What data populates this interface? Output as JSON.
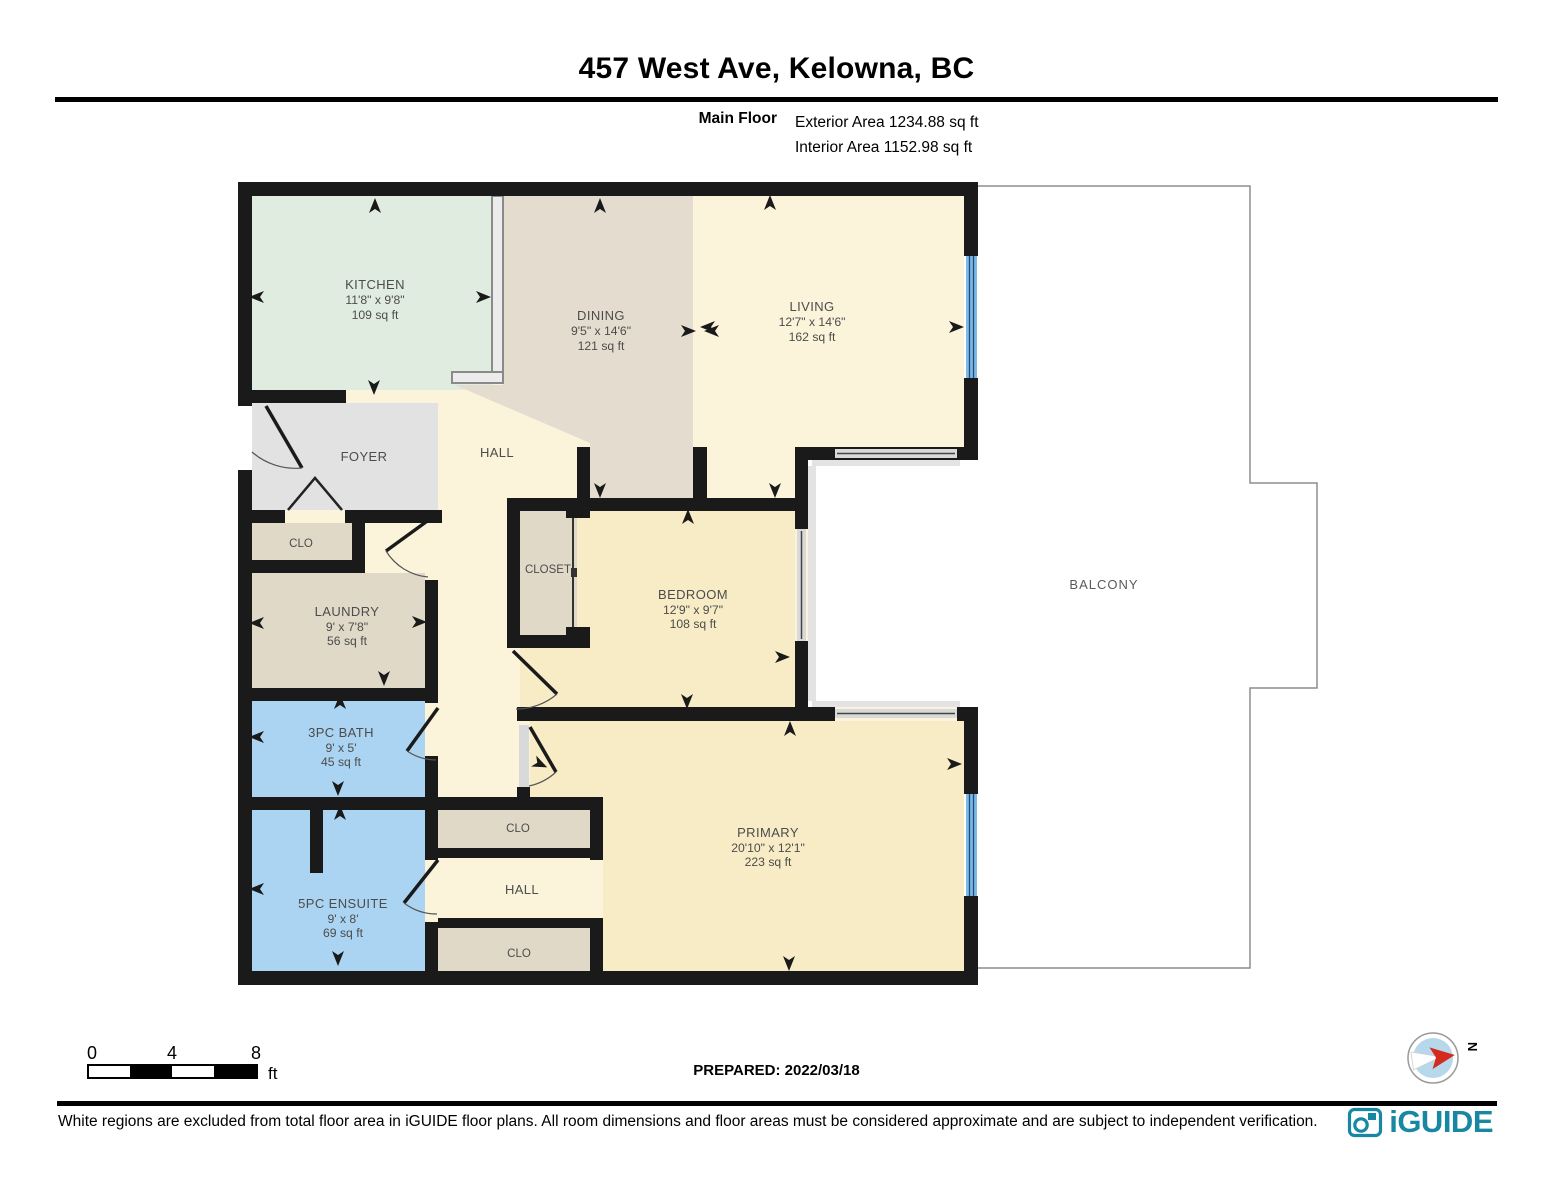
{
  "header": {
    "title": "457 West Ave, Kelowna, BC",
    "floor_label": "Main Floor",
    "exterior_area": "Exterior Area 1234.88 sq ft",
    "interior_area": "Interior Area 1152.98 sq ft"
  },
  "rooms": {
    "kitchen": {
      "name": "KITCHEN",
      "dims": "11'8\" x 9'8\"",
      "area": "109 sq ft"
    },
    "dining": {
      "name": "DINING",
      "dims": "9'5\" x 14'6\"",
      "area": "121 sq ft"
    },
    "living": {
      "name": "LIVING",
      "dims": "12'7\" x 14'6\"",
      "area": "162 sq ft"
    },
    "foyer": {
      "name": "FOYER"
    },
    "hall_upper": {
      "name": "HALL"
    },
    "clo_foyer": {
      "name": "CLO"
    },
    "laundry": {
      "name": "LAUNDRY",
      "dims": "9' x 7'8\"",
      "area": "56 sq ft"
    },
    "closet_bedroom": {
      "name": "CLOSET"
    },
    "bedroom": {
      "name": "BEDROOM",
      "dims": "12'9\" x 9'7\"",
      "area": "108 sq ft"
    },
    "balcony": {
      "name": "BALCONY"
    },
    "bath_3pc": {
      "name": "3PC BATH",
      "dims": "9' x 5'",
      "area": "45 sq ft"
    },
    "ensuite_5pc": {
      "name": "5PC ENSUITE",
      "dims": "9' x 8'",
      "area": "69 sq ft"
    },
    "clo_primary_top": {
      "name": "CLO"
    },
    "hall_lower": {
      "name": "HALL"
    },
    "clo_primary_bottom": {
      "name": "CLO"
    },
    "primary": {
      "name": "PRIMARY",
      "dims": "20'10\" x 12'1\"",
      "area": "223 sq ft"
    }
  },
  "scale_bar": {
    "tick_0": "0",
    "tick_4": "4",
    "tick_8": "8",
    "unit": "ft"
  },
  "compass": {
    "north_label": "N"
  },
  "footer": {
    "prepared": "PREPARED: 2022/03/18",
    "disclaimer": "White regions are excluded from total floor area in iGUIDE floor plans. All room dimensions and floor areas must be considered approximate and are subject to independent verification.",
    "brand": "iGUIDE"
  },
  "colors": {
    "wall": "#1a1a1a",
    "kitchen": "#e0ecdf",
    "dining": "#e4ddcf",
    "cream": "#fbf4da",
    "bedroom": "#f8ecc6",
    "primary": "#f8ecc6",
    "foyer": "#e2e2e2",
    "closet_tan": "#e0d9c8",
    "bath_blue": "#abd4f2",
    "window_blue": "#7fb8e6",
    "window_line": "#1d4e75",
    "slide_gray": "#d9d9d9",
    "threshold_gray": "#e3e3e3",
    "balcony_outline": "#8e8e8e",
    "brand_teal": "#1887a3",
    "compass_blue": "#b7d7ea",
    "compass_red": "#d42b1e"
  }
}
